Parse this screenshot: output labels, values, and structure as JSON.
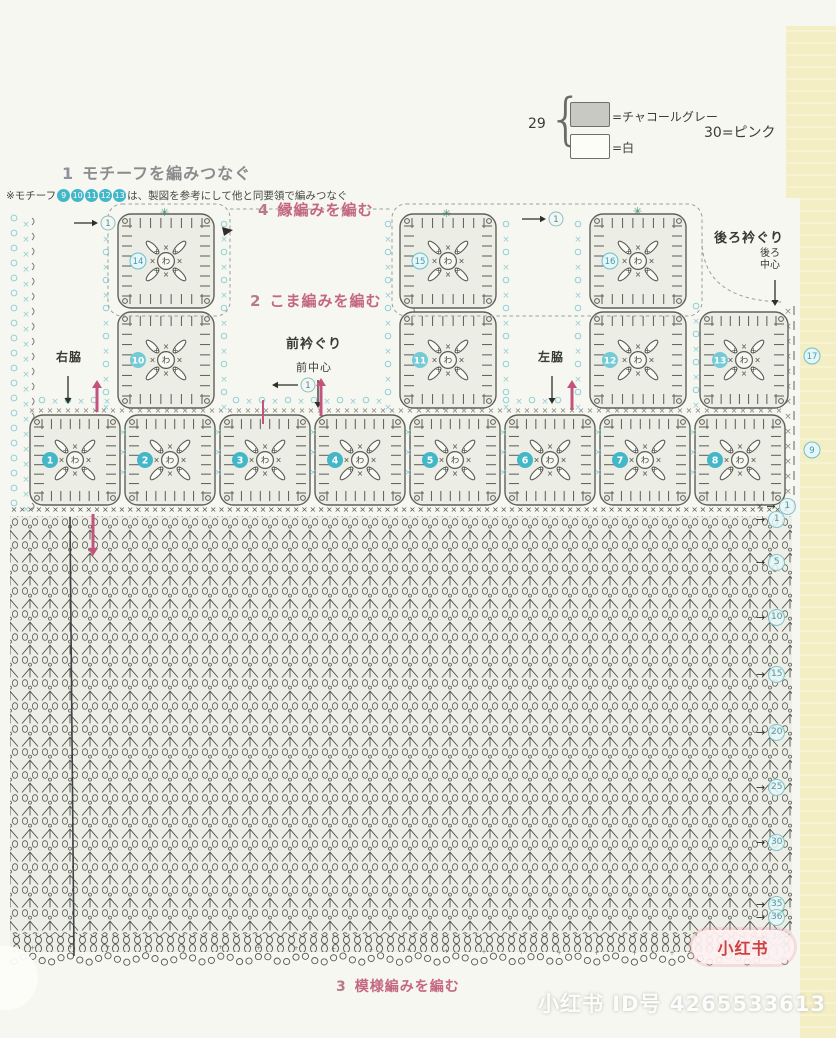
{
  "colors": {
    "pink_header": "#c4677f",
    "pink_arrow": "#c2547e",
    "cyan": "#43b7c8",
    "cyan_light": "#8fd0d6",
    "stitch_gray": "#57574f",
    "pattern_bg": "#edefe7",
    "page_bg": "#f7f7f1",
    "yellow_edge": "#f3eec4"
  },
  "legend": {
    "group_number": "29",
    "items": [
      {
        "swatch": "charcoal-gray-swatch",
        "label": "=チャコールグレー"
      },
      {
        "swatch": "white-swatch",
        "label": "=白"
      }
    ],
    "right_label": "30=ピンク"
  },
  "sections": {
    "one": {
      "num": "1",
      "title": "モチーフを編みつなぐ"
    },
    "two": {
      "num": "2",
      "title": "こま編みを編む"
    },
    "three": {
      "num": "3",
      "title": "模様編みを編む"
    },
    "four": {
      "num": "4",
      "title": "縁編みを編む"
    }
  },
  "note": {
    "prefix": "※モチーフ",
    "motif_numbers": [
      "9",
      "10",
      "11",
      "12",
      "13"
    ],
    "suffix": "は、製図を参考にして他と同要領で編みつなぐ"
  },
  "labels": {
    "right_side": "右脇",
    "left_side": "左脇",
    "front_neck": "前衿ぐり",
    "front_center": "前中心",
    "back_neck": "後ろ衿ぐり",
    "back_center_line1": "後ろ",
    "back_center_line2": "中心"
  },
  "glyphs": {
    "ring_center": "わ",
    "cross": "×",
    "plus": "+",
    "star": "✳",
    "arrow_right": "→",
    "arrow_left": "←",
    "one": "1"
  },
  "motifs": {
    "bottom_row": [
      "1",
      "2",
      "3",
      "4",
      "5",
      "6",
      "7",
      "8"
    ],
    "middle_row": [
      "10",
      "11",
      "12",
      "13"
    ],
    "top_row": [
      "14",
      "15",
      "16"
    ],
    "right_edge_top": "17",
    "right_edge_bottom": "9"
  },
  "row_markers": [
    "1",
    "1",
    "5",
    "10",
    "15",
    "20",
    "25",
    "30",
    "35",
    "36",
    "38",
    "1"
  ],
  "watermark": {
    "badge": "小红书",
    "text": "小红书 ID号 4265533613"
  }
}
